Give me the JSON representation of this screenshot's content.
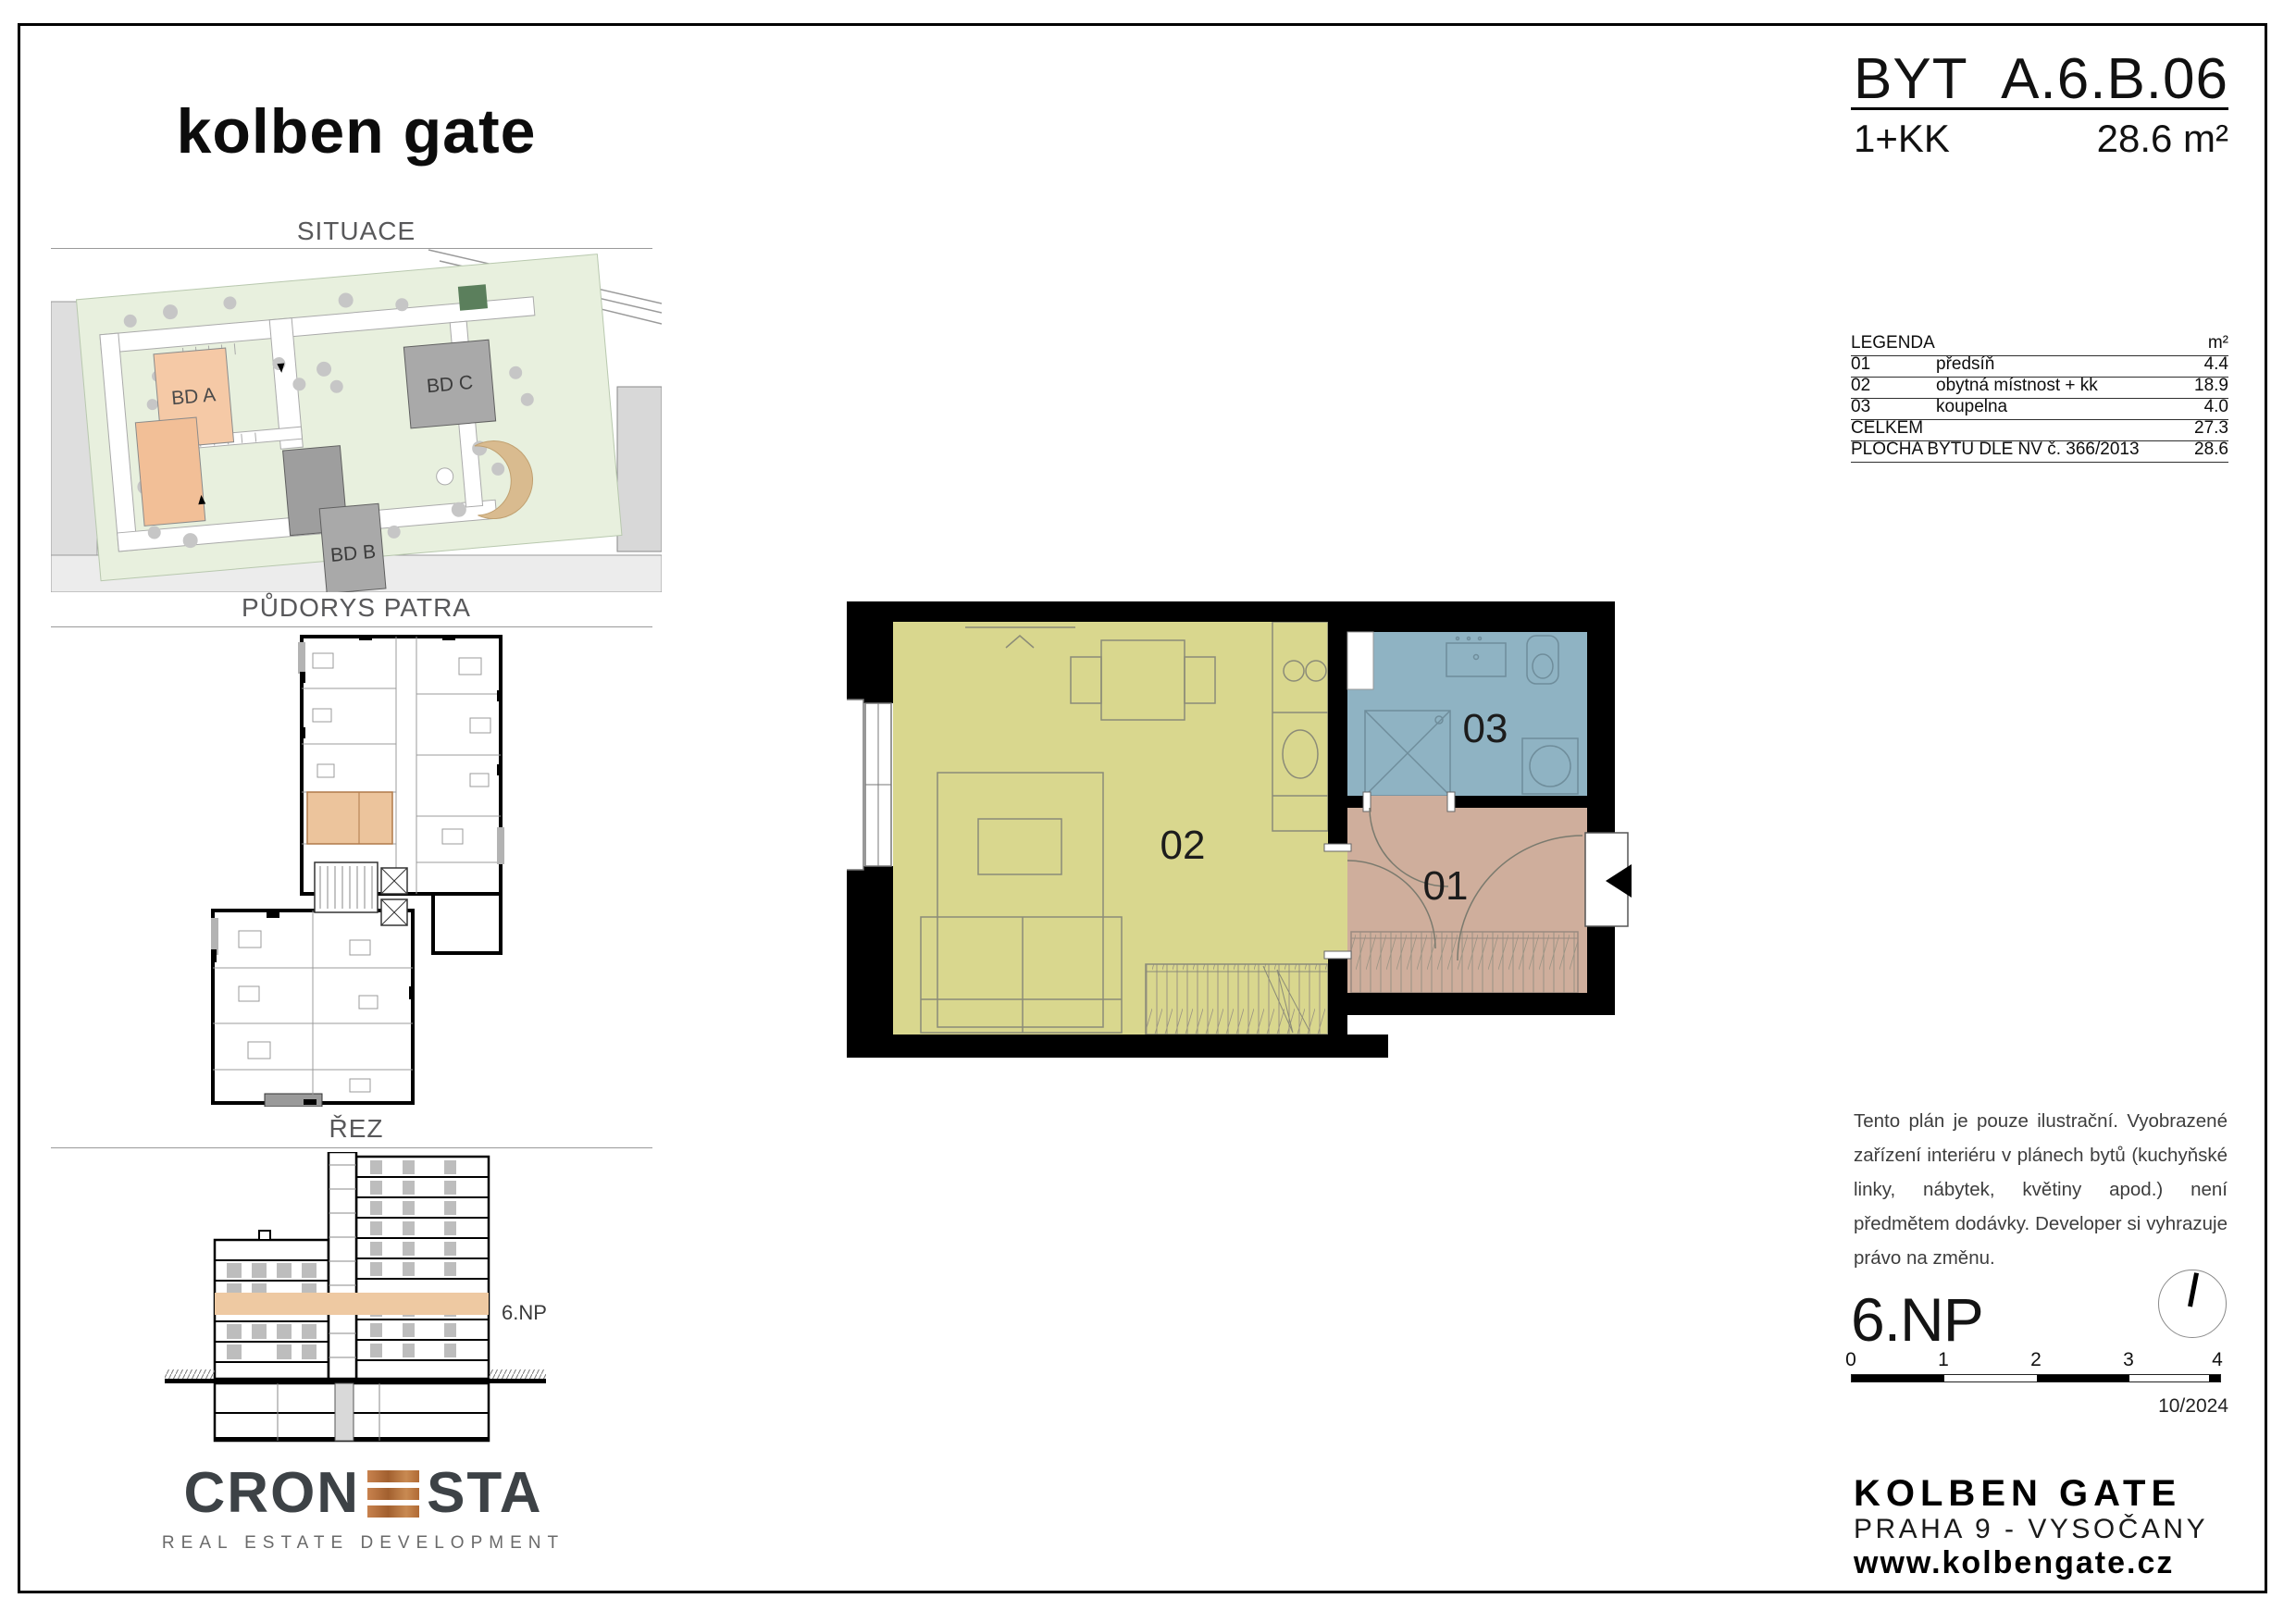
{
  "header": {
    "logo": "kolben gate"
  },
  "title_block": {
    "byt_label": "BYT",
    "unit_code": "A.6.B.06",
    "layout": "1+KK",
    "area": "28.6 m²"
  },
  "left_column": {
    "situace_title": "SITUACE",
    "pudorys_title": "PŮDORYS PATRA",
    "rez_title": "ŘEZ",
    "rez_floor_label": "6.NP",
    "site_labels": {
      "bd_a": "BD A",
      "bd_b": "BD B",
      "bd_c": "BD C"
    }
  },
  "legend": {
    "title": "LEGENDA",
    "unit_header": "m²",
    "rows": [
      {
        "num": "01",
        "name": "předsíň",
        "area": "4.4"
      },
      {
        "num": "02",
        "name": "obytná místnost + kk",
        "area": "18.9"
      },
      {
        "num": "03",
        "name": "koupelna",
        "area": "4.0"
      }
    ],
    "total_label": "CELKEM",
    "total_value": "27.3",
    "plocha_label": "PLOCHA BYTU DLE NV č. 366/2013",
    "plocha_value": "28.6"
  },
  "plan": {
    "rooms": [
      {
        "id": "01",
        "name": "předsíň"
      },
      {
        "id": "02",
        "name": "obytná místnost + kk"
      },
      {
        "id": "03",
        "name": "koupelna"
      }
    ]
  },
  "disclaimer": "Tento plán je pouze ilustrační. Vyobrazené zařízení interiéru v plánech bytů (kuchyňské linky, nábytek, květiny apod.) není předmětem dodávky. Developer si vyhrazuje právo na změnu.",
  "floor_info": {
    "floor": "6.NP",
    "scale_ticks": [
      "0",
      "1",
      "2",
      "3",
      "4"
    ],
    "date": "10/2024"
  },
  "footer": {
    "project": "KOLBEN GATE",
    "location": "PRAHA 9 - VYSOČANY",
    "website": "www.kolbengate.cz"
  },
  "cronesta": {
    "part1": "CRON",
    "part2": "STA",
    "subtitle": "REAL ESTATE DEVELOPMENT"
  },
  "colors": {
    "room_living": "#d9d78e",
    "room_bath": "#8fb3c3",
    "room_hall": "#cfae9c",
    "highlight_orange": "#ecc49c",
    "bd_a_salmon": "#f5c9a6",
    "building_gray": "#a5a5a5",
    "site_green": "#e8f0de",
    "copper": "#b06a35"
  }
}
